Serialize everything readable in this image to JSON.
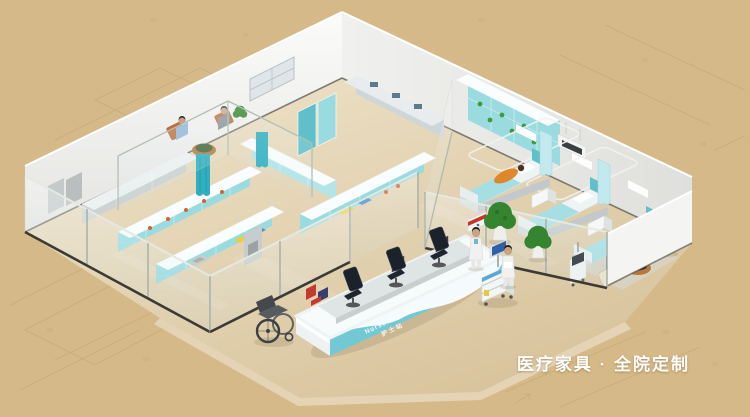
{
  "scene": {
    "title_caption": "医疗家具 · 全院定制",
    "nurse_station": {
      "label_en": "Nurse Station",
      "label_zh": "护士站"
    },
    "colors": {
      "background": "#d6b988",
      "blueprint_line": "#bda373",
      "floor_light": "#efe4cb",
      "floor_tan": "#d8c39c",
      "wall_white": "#f4f4f2",
      "wall_shade": "#e3e3e0",
      "baseboard_dark": "#3b3a35",
      "glass_tint": "#dff0f3",
      "glass_frame": "#c2cfc6",
      "cabinet_teal": "#9adbe0",
      "cabinet_teal_deep": "#5fc0cb",
      "cabinet_top_white": "#fafdfd",
      "curtain_teal": "#2fafc0",
      "bed_white": "#eef3f3",
      "bed_teal": "#a6dfe3",
      "desk_teal": "#72c9d4",
      "desk_white": "#f7fbfb",
      "chair_dark": "#20262f",
      "sign_red": "#c6372b",
      "plant_green": "#35842f",
      "pot_white": "#efefec",
      "wood_brown": "#b5793f",
      "coat_white": "#f1f1ef",
      "scrub_blue": "#8fb4d8",
      "skin": "#caa182",
      "caption_white": "#fdfdfd"
    }
  }
}
